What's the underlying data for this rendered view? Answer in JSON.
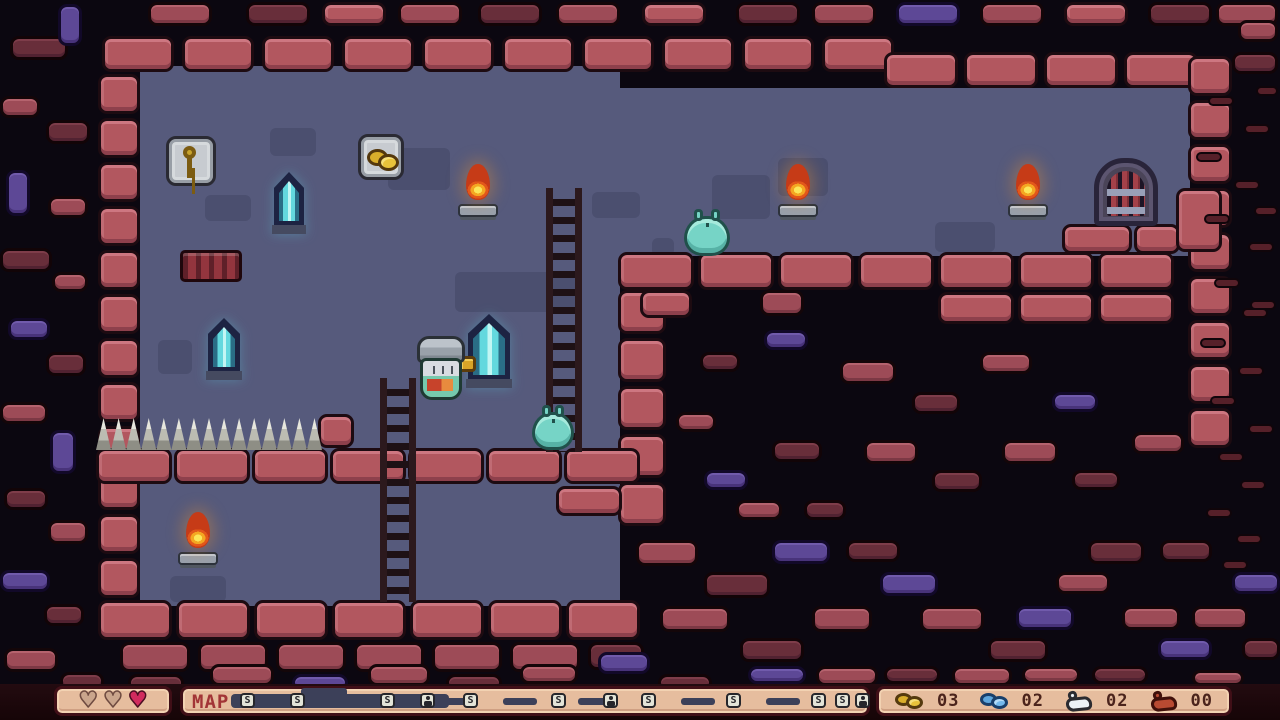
{
  "palette": {
    "void": "#0b0710",
    "room": "#565a7c",
    "brick_wall": "#b2575f",
    "brick_outside": "#9d4b57",
    "brick_dark": "#682e3a",
    "brick_purple": "#5d4896",
    "hud_panel": "#e6bd9e",
    "hud_bar": "#1d080d",
    "heart_full": "#d12b5e",
    "heart_empty": "#caa58c",
    "map_track": "#3c4059",
    "slime": "#76d4c6",
    "flame": "#f4a722",
    "crystal": "#63d8de",
    "gold": "#d9ae2b",
    "blue_coin": "#5ea6dd"
  },
  "hud": {
    "map_label": "MAP",
    "hearts": [
      "empty",
      "empty",
      "full"
    ],
    "counters": [
      {
        "icon": "gold-coins-icon",
        "cls": "gold",
        "value": "03"
      },
      {
        "icon": "blue-coins-icon",
        "cls": "blue",
        "value": "02"
      },
      {
        "icon": "white-flask-icon",
        "cls": "white",
        "value": "02"
      },
      {
        "icon": "red-flask-icon",
        "cls": "red",
        "value": "00"
      }
    ],
    "map_dark": {
      "x": 48,
      "w": 218,
      "bump_x": 118,
      "bump_w": 46
    },
    "map_dashes": [
      82,
      140,
      258,
      320,
      395,
      498,
      583
    ],
    "map_nodes": [
      {
        "x": 57,
        "t": "s"
      },
      {
        "x": 107,
        "t": "s"
      },
      {
        "x": 197,
        "t": "s"
      },
      {
        "x": 237,
        "t": "f"
      },
      {
        "x": 280,
        "t": "s"
      },
      {
        "x": 368,
        "t": "s"
      },
      {
        "x": 420,
        "t": "f"
      },
      {
        "x": 458,
        "t": "s"
      },
      {
        "x": 543,
        "t": "s"
      },
      {
        "x": 628,
        "t": "s"
      },
      {
        "x": 652,
        "t": "s"
      },
      {
        "x": 672,
        "t": "f"
      }
    ]
  },
  "stage": {
    "w": 1280,
    "h": 684,
    "sprites": [
      {
        "t": "roombg",
        "n": "room-background",
        "x": 140,
        "y": 66,
        "w": 480,
        "h": 540
      },
      {
        "t": "roombg",
        "n": "corridor-background",
        "x": 614,
        "y": 88,
        "w": 576,
        "h": 168
      },
      {
        "t": "shadow",
        "n": "background-shadow",
        "x": 270,
        "y": 128,
        "w": 46,
        "h": 28
      },
      {
        "t": "shadow",
        "n": "background-shadow",
        "x": 388,
        "y": 148,
        "w": 62,
        "h": 42
      },
      {
        "t": "shadow",
        "n": "background-shadow",
        "x": 205,
        "y": 195,
        "w": 46,
        "h": 26
      },
      {
        "t": "shadow",
        "n": "background-shadow",
        "x": 592,
        "y": 192,
        "w": 48,
        "h": 26
      },
      {
        "t": "shadow",
        "n": "background-shadow",
        "x": 712,
        "y": 175,
        "w": 58,
        "h": 44
      },
      {
        "t": "shadow",
        "n": "background-shadow",
        "x": 778,
        "y": 158,
        "w": 50,
        "h": 38
      },
      {
        "t": "shadow",
        "n": "background-shadow",
        "x": 935,
        "y": 222,
        "w": 60,
        "h": 30
      },
      {
        "t": "shadow",
        "n": "background-shadow",
        "x": 455,
        "y": 272,
        "w": 126,
        "h": 40
      },
      {
        "t": "shadow",
        "n": "background-shadow",
        "x": 158,
        "y": 340,
        "w": 34,
        "h": 34
      },
      {
        "t": "shadow",
        "n": "background-shadow",
        "x": 170,
        "y": 576,
        "w": 56,
        "h": 26
      },
      {
        "t": "shadow",
        "n": "background-shadow",
        "x": 652,
        "y": 238,
        "w": 22,
        "h": 18
      },
      {
        "x": 102,
        "y": 36,
        "w": 72,
        "h": 36,
        "r": 10,
        "dx": 80
      },
      {
        "x": 884,
        "y": 52,
        "w": 74,
        "h": 36,
        "r": 4,
        "dx": 80
      },
      {
        "x": 98,
        "y": 74,
        "w": 42,
        "h": 40,
        "r": 12,
        "dy": 44
      },
      {
        "x": 1188,
        "y": 56,
        "w": 44,
        "h": 40,
        "r": 9,
        "dy": 44
      },
      {
        "x": 618,
        "y": 252,
        "w": 76,
        "h": 38,
        "r": 7,
        "dx": 80
      },
      {
        "x": 938,
        "y": 292,
        "w": 76,
        "h": 32,
        "r": 3,
        "dx": 80
      },
      {
        "x": 1062,
        "y": 224,
        "w": 70,
        "h": 30
      },
      {
        "x": 1134,
        "y": 224,
        "w": 46,
        "h": 30
      },
      {
        "x": 1176,
        "y": 188,
        "w": 46,
        "h": 64
      },
      {
        "x": 618,
        "y": 290,
        "w": 48,
        "h": 44,
        "r": 5,
        "dy": 48
      },
      {
        "x": 96,
        "y": 448,
        "w": 76,
        "h": 36,
        "r": 7,
        "dx": 78
      },
      {
        "x": 556,
        "y": 486,
        "w": 66,
        "h": 30
      },
      {
        "x": 318,
        "y": 414,
        "w": 36,
        "h": 34
      },
      {
        "x": 98,
        "y": 600,
        "w": 74,
        "h": 40,
        "r": 7,
        "dx": 78
      },
      {
        "x": 120,
        "y": 642,
        "w": 70,
        "h": 30,
        "r": 6,
        "dx": 78,
        "v": "s"
      },
      {
        "x": 588,
        "y": 642,
        "w": 56,
        "h": 28,
        "v": "d"
      },
      {
        "x": 640,
        "y": 290,
        "w": 52,
        "h": 28
      },
      {
        "x": 760,
        "y": 290,
        "w": 44,
        "h": 26,
        "v": "s"
      },
      {
        "x": 148,
        "y": 2,
        "w": 64,
        "h": 24,
        "v": "s"
      },
      {
        "x": 246,
        "y": 2,
        "w": 64,
        "h": 24,
        "v": "d"
      },
      {
        "x": 322,
        "y": 2,
        "w": 64,
        "h": 24,
        "v": "w"
      },
      {
        "x": 398,
        "y": 2,
        "w": 64,
        "h": 24,
        "v": "s"
      },
      {
        "x": 478,
        "y": 2,
        "w": 64,
        "h": 24,
        "v": "d"
      },
      {
        "x": 556,
        "y": 2,
        "w": 64,
        "h": 24,
        "v": "s"
      },
      {
        "x": 642,
        "y": 2,
        "w": 64,
        "h": 24,
        "v": "w"
      },
      {
        "x": 736,
        "y": 2,
        "w": 64,
        "h": 24,
        "v": "d"
      },
      {
        "x": 812,
        "y": 2,
        "w": 64,
        "h": 24,
        "v": "s"
      },
      {
        "x": 896,
        "y": 2,
        "w": 64,
        "h": 24,
        "v": "p"
      },
      {
        "x": 980,
        "y": 2,
        "w": 64,
        "h": 24,
        "v": "s"
      },
      {
        "x": 1064,
        "y": 2,
        "w": 64,
        "h": 24,
        "v": "w"
      },
      {
        "x": 1148,
        "y": 2,
        "w": 64,
        "h": 24,
        "v": "d"
      },
      {
        "x": 1216,
        "y": 2,
        "w": 62,
        "h": 24,
        "v": "s"
      },
      {
        "x": 10,
        "y": 36,
        "w": 58,
        "h": 24,
        "v": "d"
      },
      {
        "x": 58,
        "y": 4,
        "w": 24,
        "h": 42,
        "v": "p"
      },
      {
        "x": 0,
        "y": 96,
        "w": 40,
        "h": 22,
        "v": "s"
      },
      {
        "x": 46,
        "y": 120,
        "w": 44,
        "h": 24,
        "v": "d"
      },
      {
        "x": 6,
        "y": 170,
        "w": 24,
        "h": 46,
        "v": "p"
      },
      {
        "x": 48,
        "y": 196,
        "w": 40,
        "h": 22,
        "v": "s"
      },
      {
        "x": 0,
        "y": 248,
        "w": 52,
        "h": 24,
        "v": "d"
      },
      {
        "x": 52,
        "y": 272,
        "w": 36,
        "h": 20,
        "v": "s"
      },
      {
        "x": 8,
        "y": 318,
        "w": 42,
        "h": 22,
        "v": "p"
      },
      {
        "x": 46,
        "y": 352,
        "w": 40,
        "h": 24,
        "v": "d"
      },
      {
        "x": 0,
        "y": 402,
        "w": 48,
        "h": 22,
        "v": "s"
      },
      {
        "x": 50,
        "y": 430,
        "w": 26,
        "h": 44,
        "v": "p"
      },
      {
        "x": 4,
        "y": 488,
        "w": 44,
        "h": 22,
        "v": "d"
      },
      {
        "x": 48,
        "y": 520,
        "w": 40,
        "h": 24,
        "v": "s"
      },
      {
        "x": 0,
        "y": 570,
        "w": 50,
        "h": 22,
        "v": "p"
      },
      {
        "x": 44,
        "y": 604,
        "w": 40,
        "h": 22,
        "v": "d"
      },
      {
        "x": 4,
        "y": 648,
        "w": 54,
        "h": 24,
        "v": "s"
      },
      {
        "x": 60,
        "y": 672,
        "w": 44,
        "h": 20,
        "v": "d"
      },
      {
        "x": 128,
        "y": 674,
        "w": 56,
        "h": 20,
        "v": "d"
      },
      {
        "x": 210,
        "y": 664,
        "w": 64,
        "h": 22,
        "v": "s"
      },
      {
        "x": 292,
        "y": 674,
        "w": 56,
        "h": 18,
        "v": "p"
      },
      {
        "x": 368,
        "y": 664,
        "w": 62,
        "h": 22,
        "v": "s"
      },
      {
        "x": 446,
        "y": 674,
        "w": 56,
        "h": 18,
        "v": "d"
      },
      {
        "x": 520,
        "y": 664,
        "w": 58,
        "h": 20,
        "v": "s"
      },
      {
        "x": 598,
        "y": 652,
        "w": 52,
        "h": 22,
        "v": "p"
      },
      {
        "x": 658,
        "y": 674,
        "w": 54,
        "h": 18,
        "v": "d"
      },
      {
        "x": 700,
        "y": 352,
        "w": 40,
        "h": 20,
        "v": "d"
      },
      {
        "x": 764,
        "y": 330,
        "w": 44,
        "h": 20,
        "v": "p"
      },
      {
        "x": 840,
        "y": 360,
        "w": 56,
        "h": 24,
        "v": "s"
      },
      {
        "x": 912,
        "y": 392,
        "w": 48,
        "h": 22,
        "v": "d"
      },
      {
        "x": 980,
        "y": 352,
        "w": 52,
        "h": 22,
        "v": "s"
      },
      {
        "x": 1052,
        "y": 392,
        "w": 46,
        "h": 20,
        "v": "p"
      },
      {
        "x": 864,
        "y": 440,
        "w": 54,
        "h": 24,
        "v": "s"
      },
      {
        "x": 932,
        "y": 470,
        "w": 50,
        "h": 22,
        "v": "d"
      },
      {
        "x": 1002,
        "y": 440,
        "w": 56,
        "h": 24,
        "v": "s"
      },
      {
        "x": 1072,
        "y": 470,
        "w": 48,
        "h": 20,
        "v": "d"
      },
      {
        "x": 1132,
        "y": 432,
        "w": 52,
        "h": 22,
        "v": "s"
      },
      {
        "x": 704,
        "y": 470,
        "w": 44,
        "h": 20,
        "v": "p"
      },
      {
        "x": 772,
        "y": 440,
        "w": 50,
        "h": 22,
        "v": "d"
      },
      {
        "x": 676,
        "y": 412,
        "w": 40,
        "h": 20,
        "v": "s"
      },
      {
        "x": 736,
        "y": 500,
        "w": 46,
        "h": 20,
        "v": "s"
      },
      {
        "x": 804,
        "y": 500,
        "w": 42,
        "h": 20,
        "v": "d"
      },
      {
        "x": 636,
        "y": 540,
        "w": 62,
        "h": 26,
        "v": "s"
      },
      {
        "x": 704,
        "y": 572,
        "w": 66,
        "h": 26,
        "v": "d"
      },
      {
        "x": 772,
        "y": 540,
        "w": 58,
        "h": 24,
        "v": "p"
      },
      {
        "x": 660,
        "y": 606,
        "w": 70,
        "h": 26,
        "v": "s"
      },
      {
        "x": 740,
        "y": 638,
        "w": 64,
        "h": 24,
        "v": "d"
      },
      {
        "x": 812,
        "y": 606,
        "w": 60,
        "h": 26,
        "v": "s"
      },
      {
        "x": 880,
        "y": 572,
        "w": 58,
        "h": 24,
        "v": "p"
      },
      {
        "x": 846,
        "y": 540,
        "w": 54,
        "h": 22,
        "v": "d"
      },
      {
        "x": 920,
        "y": 606,
        "w": 64,
        "h": 26,
        "v": "s"
      },
      {
        "x": 988,
        "y": 638,
        "w": 60,
        "h": 24,
        "v": "d"
      },
      {
        "x": 816,
        "y": 666,
        "w": 62,
        "h": 20,
        "v": "s"
      },
      {
        "x": 748,
        "y": 666,
        "w": 58,
        "h": 18,
        "v": "p"
      },
      {
        "x": 884,
        "y": 666,
        "w": 56,
        "h": 18,
        "v": "d"
      },
      {
        "x": 952,
        "y": 666,
        "w": 60,
        "h": 20,
        "v": "s"
      },
      {
        "x": 1016,
        "y": 606,
        "w": 58,
        "h": 24,
        "v": "p"
      },
      {
        "x": 1056,
        "y": 572,
        "w": 54,
        "h": 22,
        "v": "s"
      },
      {
        "x": 1088,
        "y": 540,
        "w": 56,
        "h": 24,
        "v": "d"
      },
      {
        "x": 1022,
        "y": 666,
        "w": 58,
        "h": 18,
        "v": "s"
      },
      {
        "x": 1092,
        "y": 666,
        "w": 56,
        "h": 18,
        "v": "d"
      },
      {
        "x": 1122,
        "y": 606,
        "w": 58,
        "h": 24,
        "v": "s"
      },
      {
        "x": 1158,
        "y": 638,
        "w": 54,
        "h": 22,
        "v": "p"
      },
      {
        "x": 1160,
        "y": 540,
        "w": 52,
        "h": 22,
        "v": "d"
      },
      {
        "x": 1192,
        "y": 606,
        "w": 56,
        "h": 24,
        "v": "s"
      },
      {
        "x": 1232,
        "y": 572,
        "w": 48,
        "h": 22,
        "v": "p"
      },
      {
        "x": 1242,
        "y": 638,
        "w": 38,
        "h": 22,
        "v": "d"
      },
      {
        "x": 1192,
        "y": 670,
        "w": 52,
        "h": 16,
        "v": "s"
      },
      {
        "x": 1238,
        "y": 20,
        "w": 40,
        "h": 22,
        "v": "s"
      },
      {
        "x": 1232,
        "y": 52,
        "w": 46,
        "h": 22,
        "v": "d"
      },
      {
        "x": 1208,
        "y": 96,
        "w": 26,
        "h": 10,
        "v": "d2"
      },
      {
        "x": 1244,
        "y": 124,
        "w": 26,
        "h": 10,
        "v": "d2"
      },
      {
        "x": 1196,
        "y": 152,
        "w": 26,
        "h": 10,
        "v": "d2"
      },
      {
        "x": 1234,
        "y": 180,
        "w": 26,
        "h": 10,
        "v": "d2"
      },
      {
        "x": 1204,
        "y": 214,
        "w": 26,
        "h": 10,
        "v": "d2"
      },
      {
        "x": 1248,
        "y": 242,
        "w": 26,
        "h": 10,
        "v": "d2"
      },
      {
        "x": 1214,
        "y": 278,
        "w": 26,
        "h": 10,
        "v": "d2"
      },
      {
        "x": 1242,
        "y": 308,
        "w": 26,
        "h": 10,
        "v": "d2"
      },
      {
        "x": 1200,
        "y": 338,
        "w": 26,
        "h": 10,
        "v": "d2"
      },
      {
        "x": 1238,
        "y": 366,
        "w": 26,
        "h": 10,
        "v": "d2"
      },
      {
        "x": 1210,
        "y": 396,
        "w": 26,
        "h": 10,
        "v": "d2"
      },
      {
        "x": 1248,
        "y": 424,
        "w": 26,
        "h": 10,
        "v": "d2"
      },
      {
        "x": 1218,
        "y": 452,
        "w": 26,
        "h": 10,
        "v": "d2"
      },
      {
        "x": 1240,
        "y": 480,
        "w": 26,
        "h": 10,
        "v": "d2"
      },
      {
        "x": 1206,
        "y": 508,
        "w": 26,
        "h": 10,
        "v": "d2"
      },
      {
        "x": 1236,
        "y": 534,
        "w": 26,
        "h": 10,
        "v": "d2"
      },
      {
        "x": 1254,
        "y": 206,
        "w": 24,
        "h": 10,
        "v": "d2"
      },
      {
        "x": 1256,
        "y": 86,
        "w": 22,
        "h": 10,
        "v": "d2"
      },
      {
        "x": 1250,
        "y": 300,
        "w": 26,
        "h": 10,
        "v": "d2"
      },
      {
        "x": 1222,
        "y": 560,
        "w": 26,
        "h": 10,
        "v": "d2"
      },
      {
        "t": "vent",
        "n": "wall-grate",
        "x": 180,
        "y": 250,
        "w": 62,
        "h": 32
      },
      {
        "t": "spikes",
        "n": "spikes",
        "x": 96,
        "y": 418,
        "w": 226,
        "h": 32
      },
      {
        "t": "frame frame-key",
        "n": "key-item",
        "x": 166,
        "y": 136,
        "w": 50,
        "h": 50
      },
      {
        "t": "frame frame-coins",
        "n": "coins-item",
        "x": 358,
        "y": 134,
        "w": 46,
        "h": 46
      },
      {
        "t": "crystal",
        "n": "crystal-lamp",
        "x": 272,
        "y": 172,
        "w": 34,
        "h": 62
      },
      {
        "t": "crystal",
        "n": "crystal-lamp",
        "x": 206,
        "y": 318,
        "w": 36,
        "h": 62
      },
      {
        "t": "crystal",
        "n": "crystal-lamp",
        "x": 466,
        "y": 314,
        "w": 46,
        "h": 74
      },
      {
        "t": "torch",
        "n": "torch",
        "x": 456,
        "y": 164,
        "w": 44,
        "h": 58
      },
      {
        "t": "torch",
        "n": "torch",
        "x": 776,
        "y": 164,
        "w": 44,
        "h": 58
      },
      {
        "t": "torch",
        "n": "torch",
        "x": 1006,
        "y": 164,
        "w": 44,
        "h": 58
      },
      {
        "t": "torch",
        "n": "torch",
        "x": 176,
        "y": 512,
        "w": 44,
        "h": 58
      },
      {
        "t": "door",
        "n": "exit-door",
        "x": 1094,
        "y": 158,
        "w": 64,
        "h": 68
      },
      {
        "t": "ladder",
        "n": "ladder",
        "x": 546,
        "y": 188,
        "w": 36,
        "h": 264
      },
      {
        "t": "ladder",
        "n": "ladder",
        "x": 380,
        "y": 378,
        "w": 36,
        "h": 224
      },
      {
        "t": "slime",
        "n": "slime-enemy",
        "x": 684,
        "y": 216,
        "w": 46,
        "h": 40
      },
      {
        "t": "slime",
        "n": "slime-enemy",
        "x": 532,
        "y": 412,
        "w": 42,
        "h": 38
      },
      {
        "t": "hilt",
        "n": "player-sword-hilt",
        "x": 458,
        "y": 356,
        "w": 18,
        "h": 16
      },
      {
        "t": "player",
        "n": "player-character",
        "x": 414,
        "y": 336,
        "w": 54,
        "h": 64
      }
    ]
  }
}
